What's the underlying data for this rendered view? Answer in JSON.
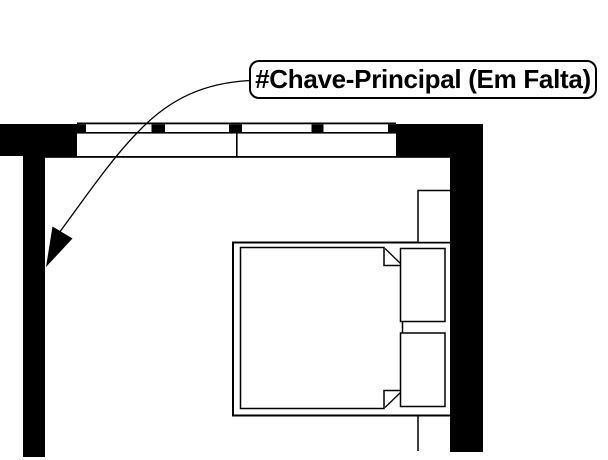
{
  "callout": {
    "label": "#Chave-Principal (Em Falta)"
  },
  "icons": {
    "leader_arrowhead": "filled-triangle-pointer"
  },
  "colors": {
    "ink": "#000000",
    "paper": "#ffffff"
  }
}
